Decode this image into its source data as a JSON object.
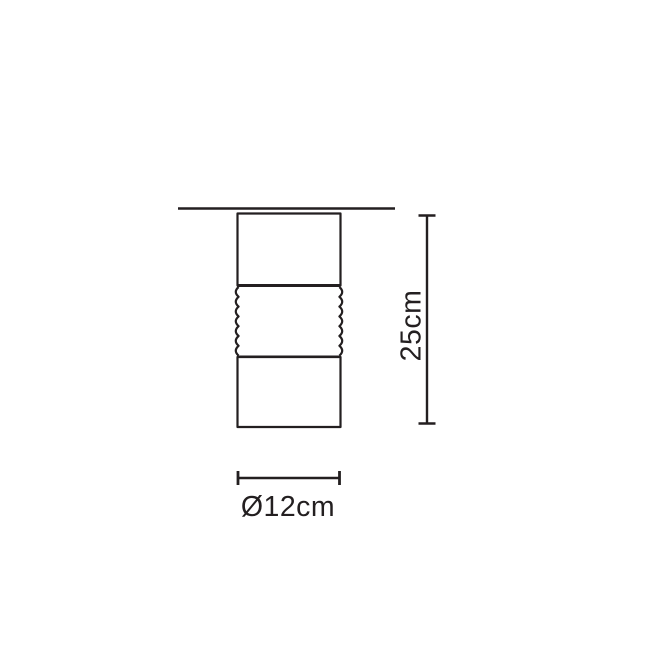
{
  "canvas": {
    "background": "#ffffff",
    "line_color": "#231f20"
  },
  "diagram": {
    "dimensions": {
      "height": {
        "label": "25cm"
      },
      "diameter": {
        "label": "Ø12cm"
      }
    }
  }
}
